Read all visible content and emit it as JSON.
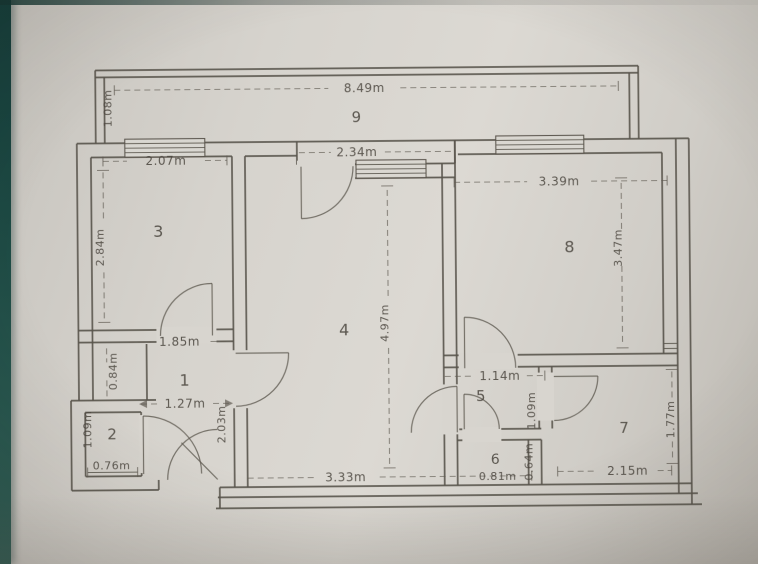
{
  "figure": {
    "kind": "scanned apartment floor plan photo"
  },
  "colors": {
    "paper": "#d8d5cf",
    "ink": "#59544c",
    "photo_edge": "#1d4a44"
  },
  "rooms": {
    "r1": "1",
    "r2": "2",
    "r3": "3",
    "r4": "4",
    "r5": "5",
    "r6": "6",
    "r7": "7",
    "r8": "8",
    "r9": "9"
  },
  "dims": {
    "total_width": "8.49m",
    "balcony_depth": "1.08m",
    "room3_width": "2.07m",
    "room3_height": "2.84m",
    "room4_top_width": "2.34m",
    "room4_height": "4.97m",
    "room8_width": "3.39m",
    "room8_height": "3.47m",
    "hall_top_width": "1.85m",
    "closet_depth": "0.84m",
    "hall_bottom_width": "1.27m",
    "hall_height": "2.03m",
    "wc2_height": "1.09m",
    "wc2_width": "0.76m",
    "hall5_width": "1.14m",
    "hall5_height": "1.09m",
    "room6_width": "0.81m",
    "room6_height": "0.64m",
    "room7_width": "2.15m",
    "room7_height": "1.77m",
    "bottom_span": "3.33m"
  }
}
